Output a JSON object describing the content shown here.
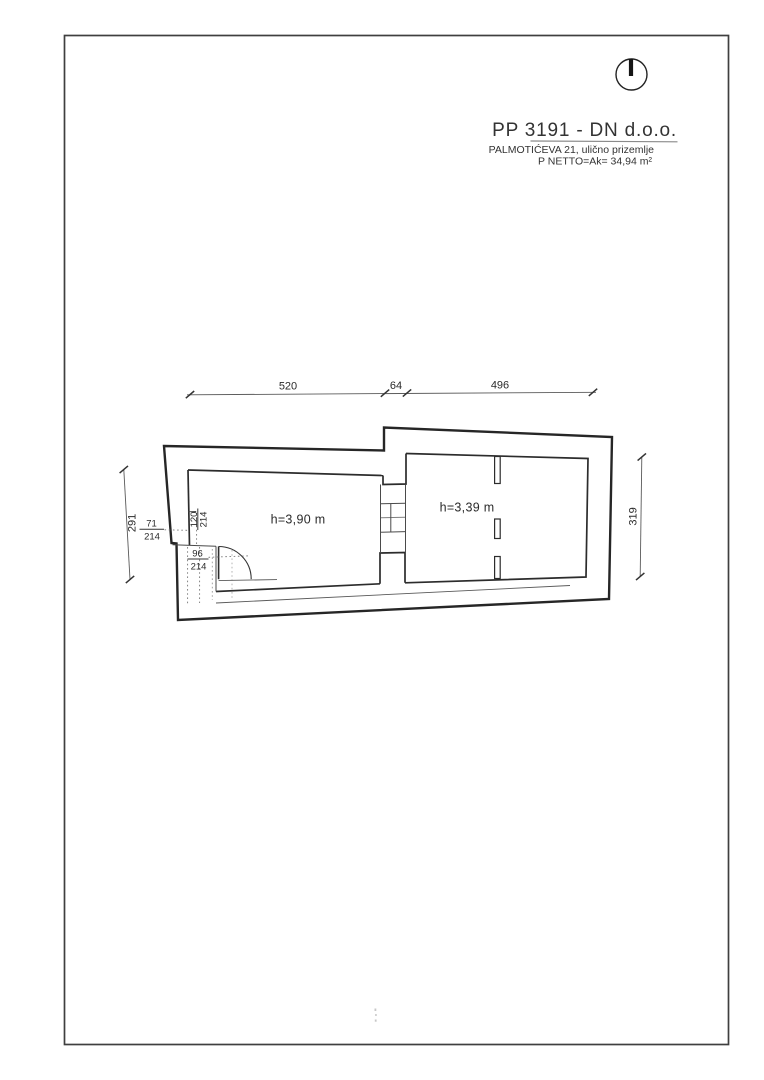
{
  "colors": {
    "ink": "#2a2a2a",
    "paper": "#ffffff"
  },
  "title_block": {
    "title": "PP 3191 - DN d.o.o.",
    "address": "PALMOTIĆEVA 21, ulično prizemlje",
    "area": "P NETTO=Ak= 34,94 m²"
  },
  "dims": {
    "top": [
      "520",
      "64",
      "496"
    ],
    "left": "291",
    "right": "319"
  },
  "openings": [
    {
      "width": "71",
      "height": "214"
    },
    {
      "width": "120",
      "height": "214"
    },
    {
      "width": "96",
      "height": "214"
    }
  ],
  "rooms": [
    {
      "height_label": "h=3,90 m"
    },
    {
      "height_label": "h=3,39 m"
    }
  ]
}
